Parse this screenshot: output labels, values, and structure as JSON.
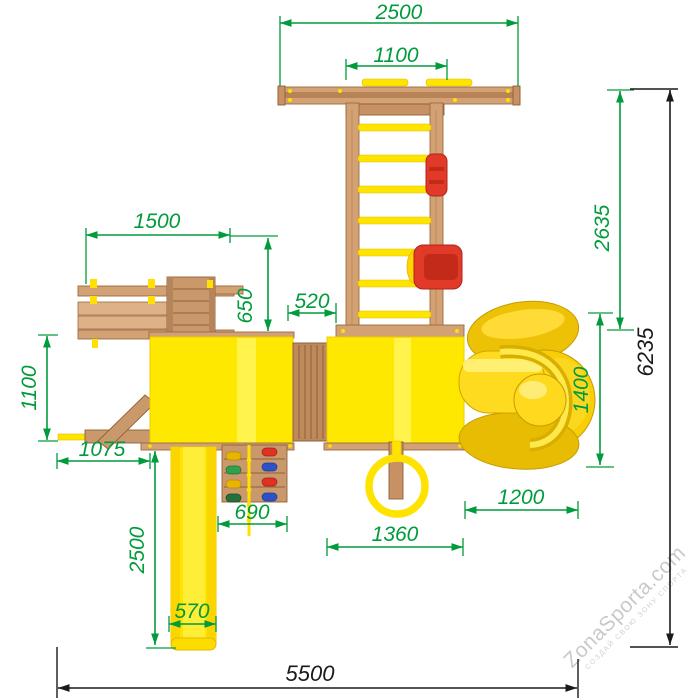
{
  "drawing": {
    "subject": "wooden playground complex — top view blueprint with dimensions (mm)"
  },
  "dims": {
    "crossbeam_length": "2500",
    "monkey_bar_span": "1100",
    "bench_length": "1500",
    "roof_to_bench_offset": "650",
    "bridge_width": "520",
    "climbing_ladder_height": "2635",
    "overall_depth": "6235",
    "left_arm_depth": "1100",
    "balance_beam_length": "1075",
    "slide_run_length": "2500",
    "climbing_wall_width": "690",
    "slide_width": "570",
    "right_tower_width": "1360",
    "spiral_slide_offset": "1200",
    "spiral_slide_depth": "1400",
    "overall_width": "5500"
  },
  "watermark": {
    "brand": "ZonaSporta.com",
    "tagline": "СОЗДАЙ СВОЮ ЗОНУ СПОРТА"
  },
  "colors": {
    "dimension_green": "#009B3C",
    "dimension_black": "#1A1A1A",
    "roof_yellow": "#FFE800",
    "part_yellow": "#FFE400",
    "wood_light": "#D3A274",
    "wood_dark": "#8F6038",
    "seat_red": "#E23A28",
    "hold_blue": "#2D52C8",
    "hold_green": "#2FA14C"
  }
}
